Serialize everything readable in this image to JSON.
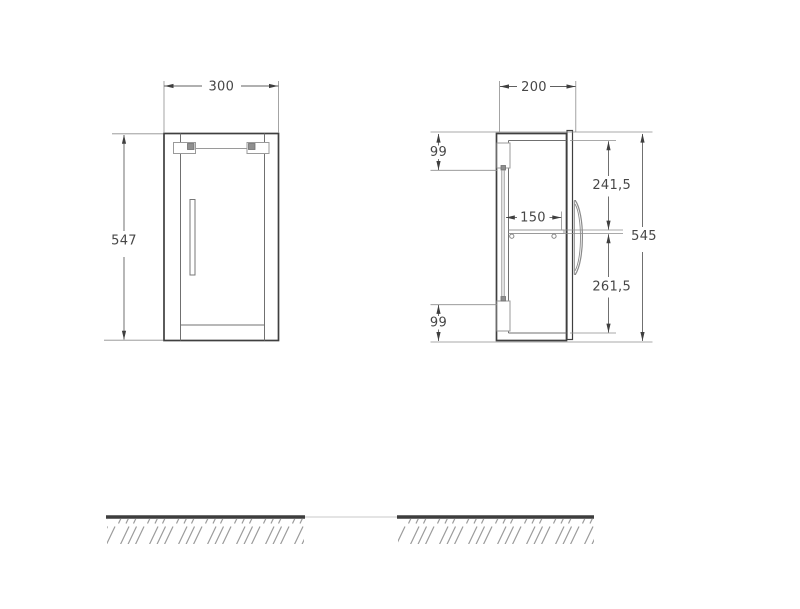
{
  "page": {
    "background": "#ffffff"
  },
  "drawing": {
    "kind": "furniture-dimension-drawing",
    "views": {
      "front": {
        "width_mm": "300",
        "height_mm": "547"
      },
      "side": {
        "depth_mm": "200",
        "height_mm": "545",
        "top_rail_offset_mm": "99",
        "bottom_rail_offset_mm": "99",
        "above_shelf_mm": "241,5",
        "below_shelf_mm": "261,5",
        "shelf_depth_mm": "150"
      }
    },
    "colors": {
      "outline": "#3f3f3f",
      "secondary_line": "#707070",
      "hardware": "#9a9a9a",
      "dimension_line": "#606060",
      "extension_line": "#8d8d8d",
      "label_text": "#474747",
      "ground": "#3d3d3d",
      "hatch": "#9b9b9b"
    }
  }
}
